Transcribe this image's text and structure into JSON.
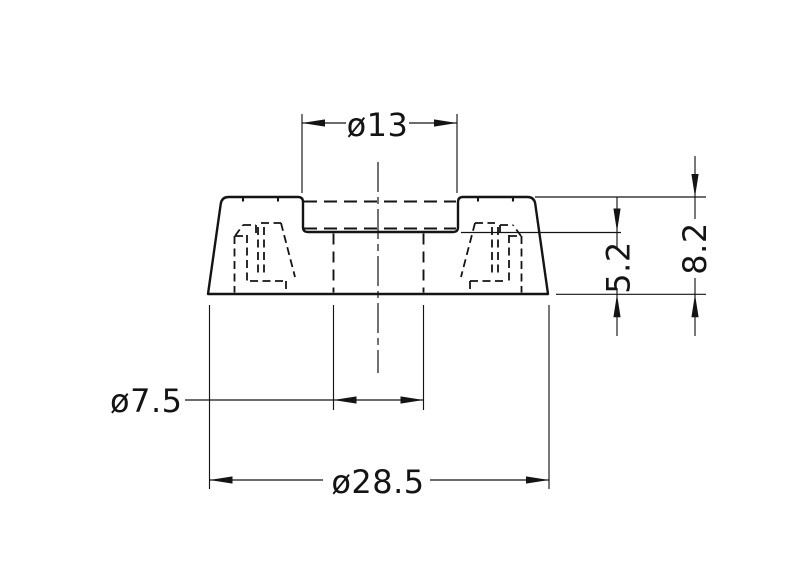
{
  "colors": {
    "background": "#ffffff",
    "line": "#141414"
  },
  "drawing": {
    "kind": "technical-drawing",
    "dimensions": {
      "recess_diameter": {
        "label": "ø13",
        "value": 13
      },
      "hole_diameter": {
        "label": "ø7.5",
        "value": 7.5
      },
      "outer_diameter": {
        "label": "ø28.5",
        "value": 28.5
      },
      "lower_height": {
        "label": "5.2",
        "value": 5.2
      },
      "overall_height": {
        "label": "8.2",
        "value": 8.2
      }
    }
  }
}
